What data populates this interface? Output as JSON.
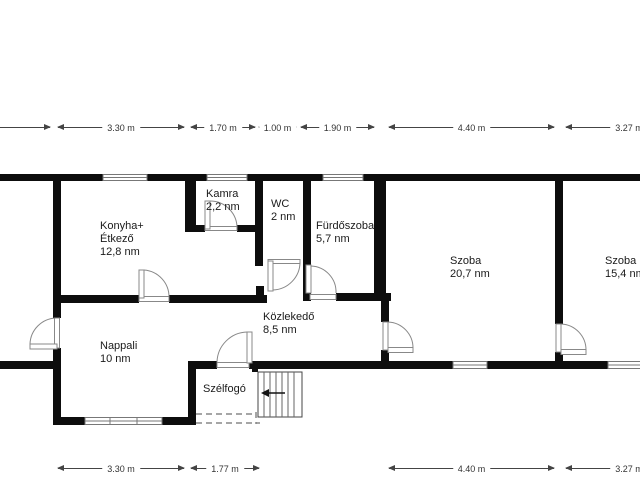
{
  "plan": {
    "rooms": {
      "konyha": {
        "line1": "Konyha+",
        "line2": "Étkező",
        "line3": "12,8 nm"
      },
      "kamra": {
        "line1": "Kamra",
        "line2": "2,2 nm"
      },
      "wc": {
        "line1": "WC",
        "line2": "2 nm"
      },
      "furdoszoba": {
        "line1": "Fürdőszoba",
        "line2": "5,7 nm"
      },
      "szoba_nagy": {
        "line1": "Szoba",
        "line2": "20,7 nm"
      },
      "szoba_kis": {
        "line1": "Szoba",
        "line2": "15,4 nm"
      },
      "nappali": {
        "line1": "Nappali",
        "line2": "10 nm"
      },
      "kozlekedo": {
        "line1": "Közlekedő",
        "line2": "8,5 nm"
      },
      "szelfogo": {
        "line1": "Szélfogó"
      }
    },
    "dimensions": {
      "top": {
        "d330": "3.30 m",
        "d170": "1.70 m",
        "d100": "1.00 m",
        "d190": "1.90 m",
        "d440": "4.40 m",
        "d327": "3.27 m"
      },
      "bottom": {
        "d330": "3.30 m",
        "d177": "1.77 m",
        "d440": "4.40 m",
        "d327": "3.27 m"
      }
    },
    "colors": {
      "wall": "#0d0d0d",
      "opening": "#777777",
      "text": "#1a1a1a",
      "dimension": "#444444",
      "background": "#ffffff"
    }
  }
}
